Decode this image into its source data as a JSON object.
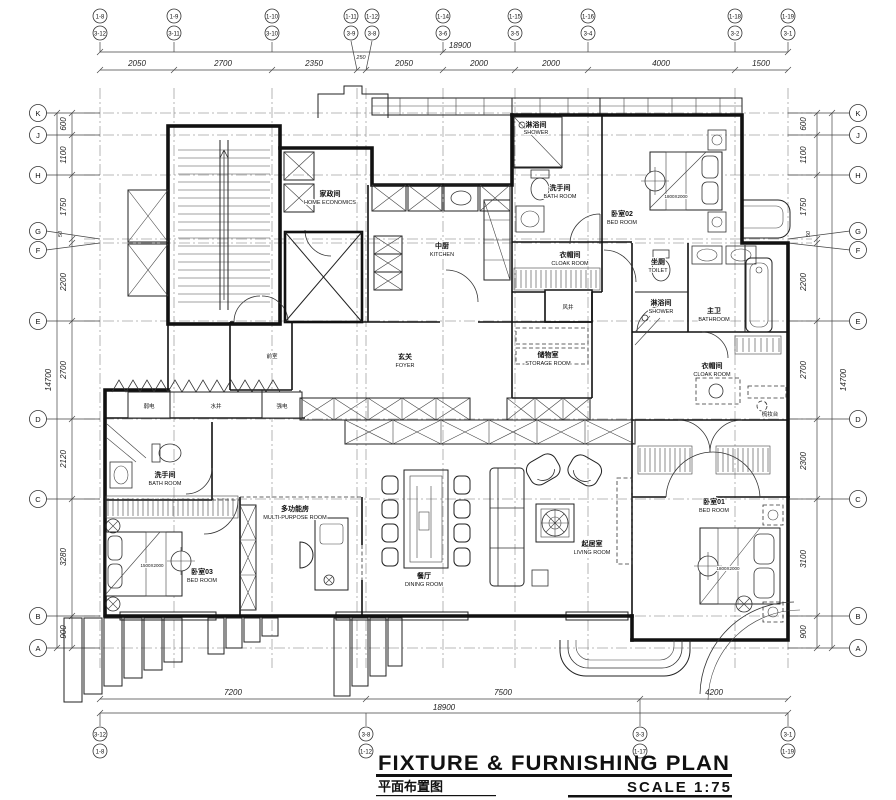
{
  "title": {
    "en": "FIXTURE & FURNISHING PLAN",
    "zh": "平面布置图",
    "scale_label": "SCALE 1:75"
  },
  "dims": {
    "top": {
      "overall": "18900",
      "segments": [
        "2050",
        "2700",
        "2350",
        "250",
        "2050",
        "2000",
        "2000",
        "4000",
        "1500"
      ]
    },
    "bottom": {
      "overall": "18900",
      "segments": [
        "7200",
        "7500",
        "4200"
      ]
    },
    "left": {
      "overall": "14700",
      "segments": [
        "600",
        "1100",
        "1750",
        "50",
        "2200",
        "2700",
        "2120",
        "3280",
        "900"
      ]
    },
    "right": {
      "overall": "14700",
      "segments": [
        "600",
        "1100",
        "1750",
        "50",
        "2200",
        "2700",
        "2300",
        "3100",
        "900"
      ]
    }
  },
  "grid": {
    "rows": [
      "K",
      "J",
      "H",
      "G",
      "F",
      "E",
      "D",
      "C",
      "B",
      "A"
    ],
    "top_cols": [
      {
        "a": "1-8",
        "b": "3-12"
      },
      {
        "a": "1-9",
        "b": "3-11"
      },
      {
        "a": "1-10",
        "b": "3-10"
      },
      {
        "a": "1-11",
        "b": "3-9"
      },
      {
        "a": "1-12",
        "b": "3-8"
      },
      {
        "a": "1-14",
        "b": "3-6"
      },
      {
        "a": "1-15",
        "b": "3-5"
      },
      {
        "a": "1-16",
        "b": "3-4"
      },
      {
        "a": "1-18",
        "b": "3-2"
      },
      {
        "a": "1-19",
        "b": "3-1"
      }
    ],
    "bottom_cols": [
      {
        "a": "3-12",
        "b": "1-8"
      },
      {
        "a": "3-8",
        "b": "1-12"
      },
      {
        "a": "3-3",
        "b": "1-17"
      },
      {
        "a": "3-1",
        "b": "1-19"
      }
    ]
  },
  "rooms": {
    "home_economics": {
      "zh": "家政间",
      "en": "HOME ECONOMICS"
    },
    "kitchen": {
      "zh": "中厨",
      "en": "KITCHEN"
    },
    "shower_top": {
      "zh": "淋浴间",
      "en": "SHOWER"
    },
    "bath_top": {
      "zh": "洗手间",
      "en": "BATH ROOM"
    },
    "bed02": {
      "zh": "卧室02",
      "en": "BED ROOM"
    },
    "cloak_top": {
      "zh": "衣帽间",
      "en": "CLOAK ROOM"
    },
    "toilet": {
      "zh": "坐厕",
      "en": "TOILET"
    },
    "shower_master": {
      "zh": "淋浴间",
      "en": "SHOWER"
    },
    "bath_master": {
      "zh": "主卫",
      "en": "BATHROOM"
    },
    "cloak_master": {
      "zh": "衣帽间",
      "en": "CLOAK ROOM"
    },
    "foyer": {
      "zh": "玄关",
      "en": "FOYER"
    },
    "storage": {
      "zh": "储物室",
      "en": "STORAGE ROOM"
    },
    "bath_left": {
      "zh": "洗手间",
      "en": "BATH ROOM"
    },
    "multi": {
      "zh": "多功能房",
      "en": "MULTI-PURPOSE ROOM"
    },
    "bed03": {
      "zh": "卧室03",
      "en": "BED ROOM"
    },
    "dining": {
      "zh": "餐厅",
      "en": "DINING ROOM"
    },
    "living": {
      "zh": "起居室",
      "en": "LIVING ROOM"
    },
    "bed01": {
      "zh": "卧室01",
      "en": "BED ROOM"
    }
  },
  "small_labels": {
    "ante_room": "前室",
    "air_shaft": "风井",
    "water_shaft": "水井",
    "strong_electric": "强电",
    "weak_electric": "弱电",
    "dressing_table": "梳妆台",
    "bed_size_queen": "1800X2000",
    "bed_size_double": "1500X2000"
  },
  "colors": {
    "line": "#1a1a1a",
    "background": "#ffffff"
  }
}
